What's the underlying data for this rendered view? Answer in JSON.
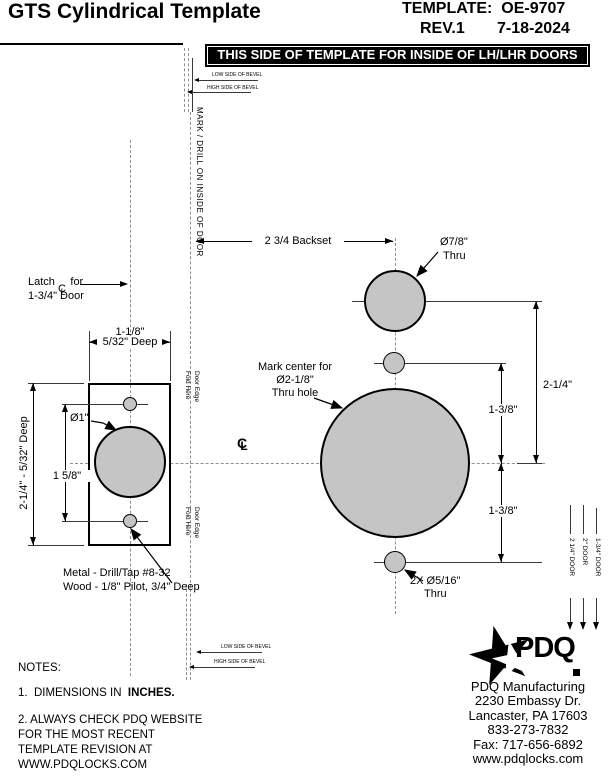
{
  "header": {
    "title": "GTS Cylindrical Template",
    "template_no": "TEMPLATE:  OE-9707",
    "rev": "REV.1",
    "date": "7-18-2024",
    "banner": "THIS SIDE OF TEMPLATE FOR INSIDE OF LH/LHR DOORS"
  },
  "bevel": {
    "low": "LOW SIDE OF BEVEL",
    "high": "HIGH SIDE OF BEVEL"
  },
  "mark_drill": "MARK / DRILL ON INSIDE OF DOOR",
  "fold": {
    "line1": "Fold Here",
    "line2": "Door Edge"
  },
  "latch": {
    "pre": "Latch",
    "post": " for",
    "line2": "1-3/4\" Door"
  },
  "cl": {
    "c": "C",
    "l": "L"
  },
  "faceplate": {
    "width_dim": "1-1/8\"",
    "width_depth": "5/32\" Deep",
    "height_dim": "2-1/4\" - 5/32\" Deep",
    "hole_spacing": "1 5/8\"",
    "bore_dia": "Ø1\"",
    "screw_note1": "Metal - Drill/Tap #8-32",
    "screw_note2": "Wood - 1/8\" Pilot, 3/4\" Deep"
  },
  "main": {
    "backset": "2 3/4 Backset",
    "top_hole_dia": "Ø7/8\"",
    "top_hole_thru": "Thru",
    "center_note": [
      "Mark center for",
      "Ø2-1/8\"",
      "Thru hole"
    ],
    "dim_vert_total": "2-1/4\"",
    "dim_upper": "1-3/8\"",
    "dim_lower": "1-3/8\"",
    "bottom_hole_dia": "2X Ø5/16\"",
    "bottom_hole_thru": "Thru"
  },
  "door_marks": [
    "2 1/4\" DOOR",
    "2\" DOOR",
    "1-3/4\" DOOR"
  ],
  "notes": {
    "heading": "NOTES:",
    "note1_prefix": "1.  DIMENSIONS IN  ",
    "note1_bold": "INCHES.",
    "note2_lines": [
      "2.  ALWAYS CHECK PDQ WEBSITE",
      "FOR THE MOST RECENT",
      "TEMPLATE REVISION AT",
      "WWW.PDQLOCKS.COM"
    ]
  },
  "company": {
    "logo_text": "PDQ",
    "address_lines": [
      "PDQ Manufacturing",
      "2230 Embassy Dr.",
      "Lancaster, PA 17603",
      "833-273-7832",
      "Fax: 717-656-6892",
      "www.pdqlocks.com"
    ]
  },
  "colors": {
    "fill_gray": "#c5c5c5",
    "line": "#000000",
    "centerline": "#8f8f8f"
  }
}
